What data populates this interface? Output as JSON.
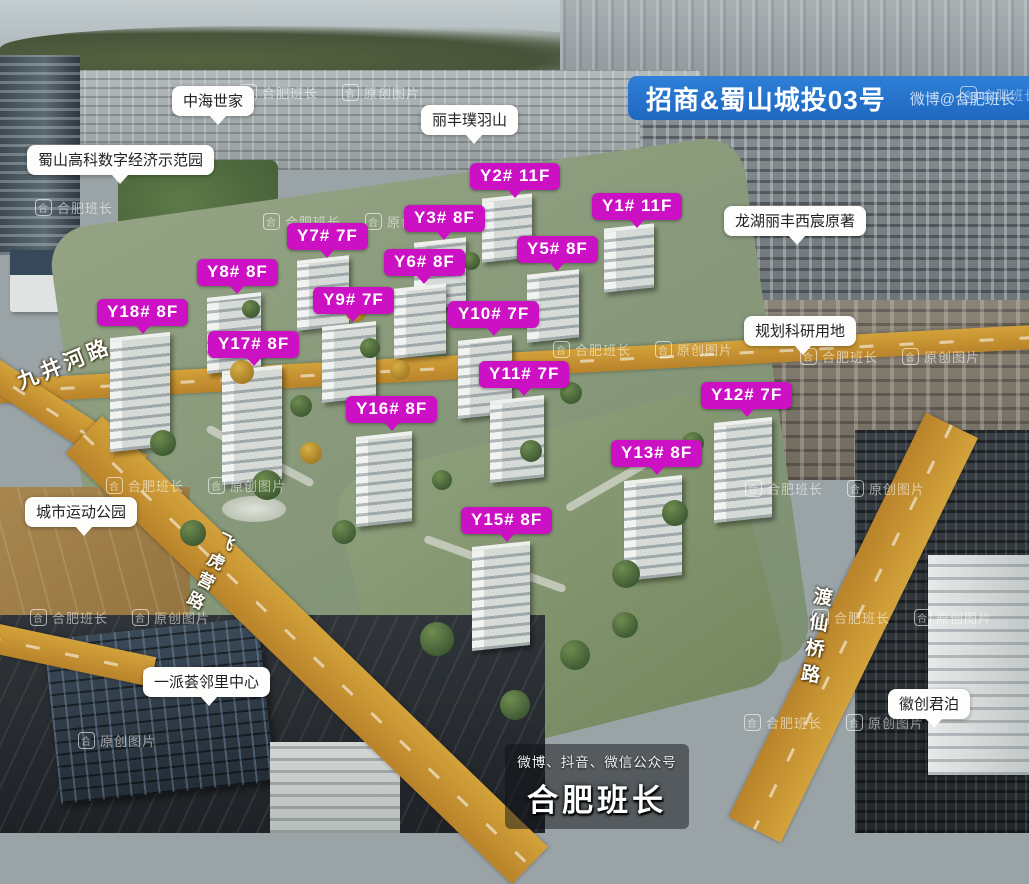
{
  "banner": {
    "title": "招商&蜀山城投03号",
    "credit": "微博@合肥班长"
  },
  "building_tags": [
    {
      "id": "Y2#",
      "floors": "11F",
      "label": "Y2# 11F"
    },
    {
      "id": "Y1#",
      "floors": "11F",
      "label": "Y1# 11F"
    },
    {
      "id": "Y3#",
      "floors": "8F",
      "label": "Y3# 8F"
    },
    {
      "id": "Y7#",
      "floors": "7F",
      "label": "Y7# 7F"
    },
    {
      "id": "Y5#",
      "floors": "8F",
      "label": "Y5# 8F"
    },
    {
      "id": "Y6#",
      "floors": "8F",
      "label": "Y6# 8F"
    },
    {
      "id": "Y8#",
      "floors": "8F",
      "label": "Y8# 8F"
    },
    {
      "id": "Y9#",
      "floors": "7F",
      "label": "Y9# 7F"
    },
    {
      "id": "Y18#",
      "floors": "8F",
      "label": "Y18# 8F"
    },
    {
      "id": "Y10#",
      "floors": "7F",
      "label": "Y10# 7F"
    },
    {
      "id": "Y17#",
      "floors": "8F",
      "label": "Y17# 8F"
    },
    {
      "id": "Y11#",
      "floors": "7F",
      "label": "Y11# 7F"
    },
    {
      "id": "Y12#",
      "floors": "7F",
      "label": "Y12# 7F"
    },
    {
      "id": "Y16#",
      "floors": "8F",
      "label": "Y16# 8F"
    },
    {
      "id": "Y13#",
      "floors": "8F",
      "label": "Y13# 8F"
    },
    {
      "id": "Y15#",
      "floors": "8F",
      "label": "Y15# 8F"
    }
  ],
  "landmarks": [
    {
      "label": "中海世家"
    },
    {
      "label": "丽丰璞羽山"
    },
    {
      "label": "蜀山高科数字经济示范园"
    },
    {
      "label": "龙湖丽丰西宸原著"
    },
    {
      "label": "规划科研用地"
    },
    {
      "label": "城市运动公园"
    },
    {
      "label": "一派荟邻里中心"
    },
    {
      "label": "徽创君泊"
    }
  ],
  "roads": [
    {
      "name": "九井河路"
    },
    {
      "name": "飞虎营路"
    },
    {
      "name": "渡仙桥路"
    }
  ],
  "watermark": {
    "logo": "合",
    "brand": "合肥班长",
    "tag": "原创图片"
  },
  "footer": {
    "line1": "微博、抖音、微信公众号",
    "line2": "合肥班长"
  },
  "colors": {
    "label_magenta": "#cb11c3",
    "banner_blue": "#2273cf",
    "road_orange": "#c9932c",
    "site_green": "#8a9a78"
  }
}
